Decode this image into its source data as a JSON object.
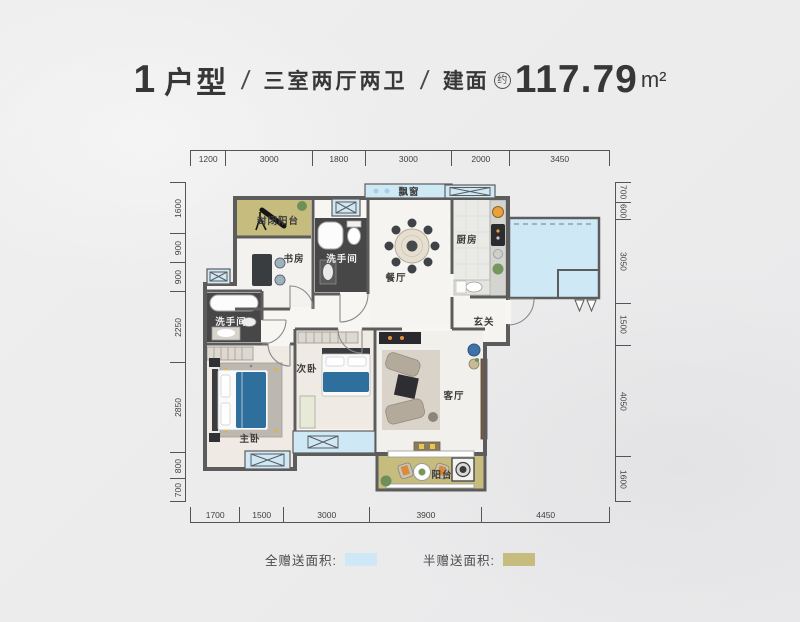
{
  "title": {
    "number": "1",
    "type_label": "户型",
    "slash": "/",
    "layout": "三室两厅两卫",
    "area_label": "建面",
    "area_approx": "约",
    "area_value": "117.79",
    "area_unit": "m²"
  },
  "dimensions": {
    "top": [
      "1200",
      "3000",
      "1800",
      "3000",
      "2000",
      "3450"
    ],
    "bottom": [
      "1700",
      "1500",
      "3000",
      "3900",
      "4450"
    ],
    "left": [
      "1600",
      "900",
      "900",
      "2250",
      "2850",
      "800",
      "700"
    ],
    "right": [
      "700",
      "600",
      "3050",
      "1500",
      "4050",
      "1600"
    ]
  },
  "rooms": {
    "bay_window": "飘窗",
    "enclosed_balcony": "封闭阳台",
    "study": "书房",
    "bathroom_top": "洗手间",
    "dining": "餐厅",
    "kitchen": "厨房",
    "foyer": "玄关",
    "bathroom_left": "洗手间",
    "bedroom_second": "次卧",
    "bedroom_master": "主卧",
    "living": "客厅",
    "balcony": "阳台"
  },
  "legend": {
    "full_gift_label": "全赠送面积:",
    "half_gift_label": "半赠送面积:"
  },
  "colors": {
    "full_gift": "#cfe8f6",
    "half_gift": "#c5bc7e",
    "wall": "#5c5c5c"
  }
}
